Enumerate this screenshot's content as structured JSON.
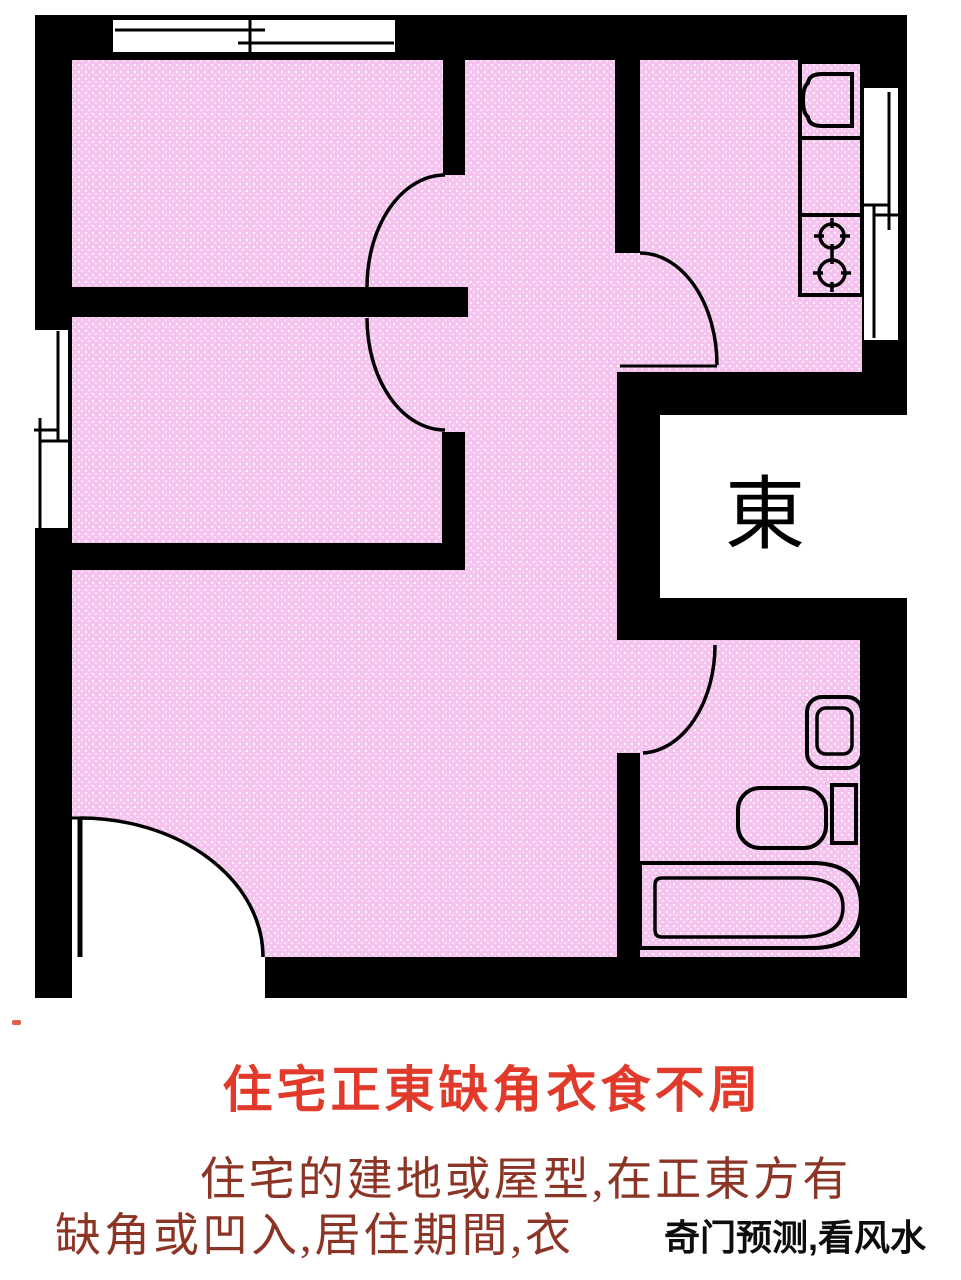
{
  "plan": {
    "east_label": "東",
    "icons": [
      "window-icon",
      "door-swing-icon",
      "kitchen-sink-icon",
      "stove-burners-icon",
      "toilet-icon",
      "washbasin-icon",
      "bathtub-icon"
    ]
  },
  "caption": {
    "title": "住宅正東缺角衣食不周",
    "line2": "住宅的建地或屋型,在正東方有",
    "line3": "缺角或凹入,居住期間,衣",
    "watermark": "奇门预测,看风水"
  },
  "colors": {
    "floor_pink": "#f5c4ee",
    "wall_black": "#000000",
    "title_red": "#e23a2a",
    "body_maroon": "#8c3425",
    "watermark_black": "#0d0d0d"
  }
}
